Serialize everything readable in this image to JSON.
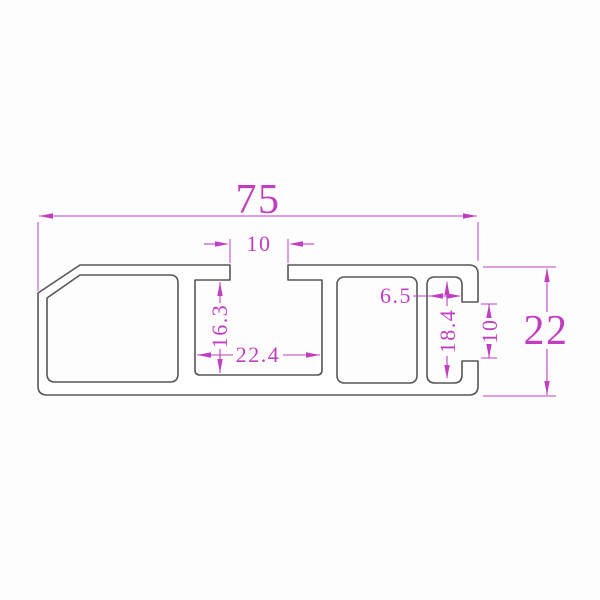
{
  "drawing": {
    "kind": "profile-cross-section-drawing",
    "colors": {
      "background": "#fdfdfd",
      "outline": "#565656",
      "dimension": "#c13ec1"
    }
  },
  "dims": {
    "overall_width": "75",
    "top_slot_width": "10",
    "overall_height": "22",
    "center_channel_depth": "16.3",
    "center_channel_width": "22.4",
    "right_slot_depth": "6.5",
    "right_slot_height": "18.4",
    "right_opening_height": "10"
  }
}
